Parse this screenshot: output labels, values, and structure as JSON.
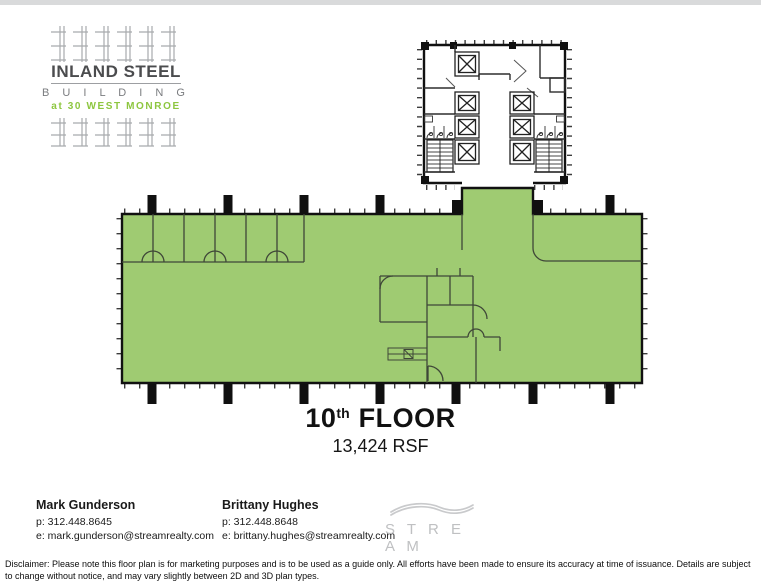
{
  "building_logo": {
    "name_line1": "INLAND STEEL",
    "name_line2": "B U I L D I N G",
    "tagline": "at 30 WEST MONROE",
    "tagline_color": "#8dc63f"
  },
  "floor_plan": {
    "floor_number": "10",
    "floor_ordinal": "th",
    "floor_label": "FLOOR",
    "area": "13,424 RSF",
    "highlight_color": "#9fcb72"
  },
  "contacts": [
    {
      "name": "Mark Gunderson",
      "phone": "p: 312.448.8645",
      "email": "e: mark.gunderson@streamrealty.com"
    },
    {
      "name": "Brittany Hughes",
      "phone": "p: 312.448.8648",
      "email": "e: brittany.hughes@streamrealty.com"
    }
  ],
  "brand": {
    "wordmark": "S T R E A M"
  },
  "disclaimer": "Disclaimer: Please note this floor plan is for marketing purposes and is to be used as a guide only. All efforts have been made to ensure its accuracy at time of issuance. Details are subject to change without notice, and may vary slightly between 2D and 3D plan types."
}
